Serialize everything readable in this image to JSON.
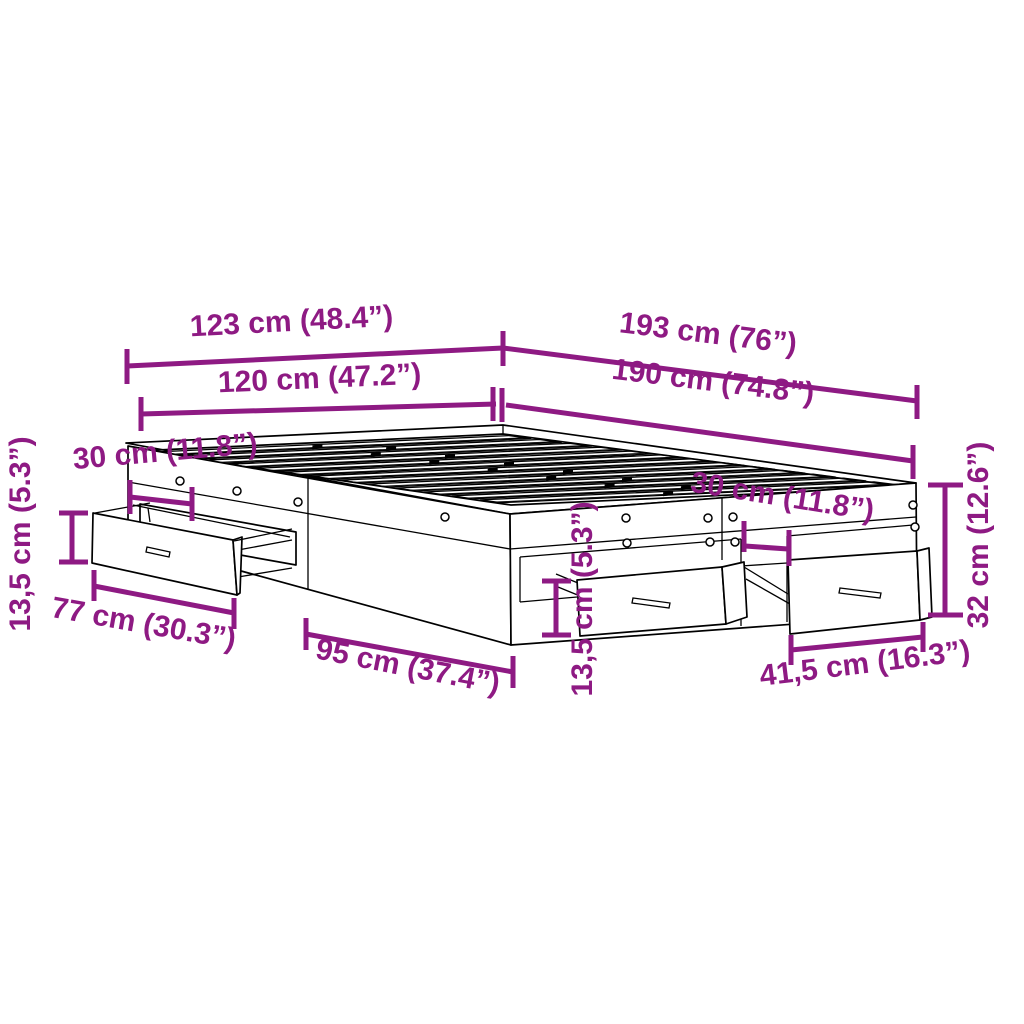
{
  "figure": {
    "description": "Dimension diagram of a bed frame with four storage drawers, line drawing with magenta measurement annotations"
  },
  "colors": {
    "dimension": "#8E1A83",
    "outline": "#000000",
    "background": "#FFFFFF"
  },
  "dimensions": {
    "total_width": "123 cm (48.4”)",
    "total_length": "193 cm (76”)",
    "inner_width": "120 cm (47.2”)",
    "inner_length": "190 cm (74.8”)",
    "head_drawer_offset": "30 cm (11.8”)",
    "left_drawer_height": "13,5 cm (5.3”)",
    "left_drawer_width": "77 cm (30.3”)",
    "side_span": "95 cm (37.4”)",
    "foot_drawer_gap": "30 cm (11.8”)",
    "mid_drawer_height": "13,5 cm (5.3”)",
    "foot_drawer_width": "41,5 cm (16.3”)",
    "frame_height": "32 cm (12.6”)"
  }
}
